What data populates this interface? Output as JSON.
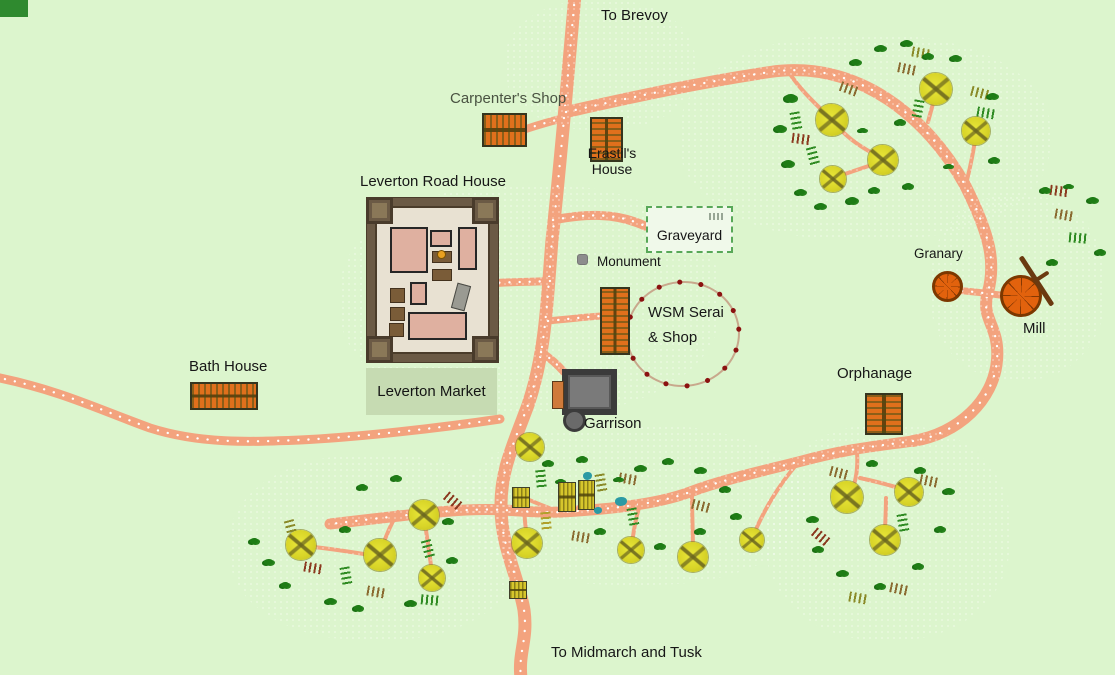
{
  "map_title": "Leverton town map",
  "palette": {
    "background": "#dcf5cd",
    "road": "#f3a37e",
    "road_dots": "#ffffff",
    "tree": "#d9d528",
    "bush": "#1e7c15",
    "pond": "#2b9aa4",
    "fence_line": "#c8a88c",
    "fence_post": "#8b1210",
    "label_default": "#161616",
    "label_muted": "#4a5342",
    "field_colors": {
      "g": "#2f8b22",
      "o": "#8a8a28",
      "t": "#8a6a30",
      "b": "#8b3a20",
      "y": "#b0a02a"
    }
  },
  "locations": {
    "to_brevoy": {
      "label": "To Brevoy"
    },
    "carpenters_shop": {
      "label": "Carpenter's Shop"
    },
    "erastils_house": {
      "label_line1": "Erastil's",
      "label_line2": "House"
    },
    "leverton_road_house": {
      "label": "Leverton Road House"
    },
    "graveyard": {
      "label": "Graveyard",
      "tombstone_marks": 4
    },
    "monument": {
      "label": "Monument"
    },
    "wsm_serai": {
      "label_line1": "WSM Serai",
      "label_line2": "& Shop"
    },
    "granary": {
      "label": "Granary"
    },
    "mill": {
      "label": "Mill"
    },
    "bath_house": {
      "label": "Bath House"
    },
    "leverton_market": {
      "label": "Leverton Market"
    },
    "garrison": {
      "label": "Garrison"
    },
    "orphanage": {
      "label": "Orphanage"
    },
    "to_midmarch": {
      "label": "To Midmarch and Tusk"
    }
  },
  "features": {
    "roads": [
      {
        "d": "M575,-5 C570,50 560,170 552,240 C547,300 546,352 528,405 C512,448 500,472 501,510 C502,548 518,576 524,610 C528,640 518,652 521,678",
        "w": 13,
        "dots": true
      },
      {
        "d": "M566,112 C620,100 690,84 770,72 C858,59 928,118 965,185 C990,235 996,262 988,292 C980,320 1000,325 997,360 C994,400 958,434 913,441",
        "w": 12,
        "dots": true
      },
      {
        "d": "M913,441 C870,447 846,449 798,462 C758,472 722,480 690,492 C658,504 612,509 562,512 C540,513 520,511 503,510 C470,508 430,512 330,524",
        "w": 11,
        "dots": true
      },
      {
        "d": "M-5,377 C60,390 100,410 150,428 C200,444 250,442 300,440 C360,437 440,428 500,419",
        "w": 9,
        "dots": true
      },
      {
        "d": "M564,118 C548,122 538,125 526,129",
        "w": 8,
        "dots": true
      },
      {
        "d": "M553,220 C585,214 615,212 645,226",
        "w": 9,
        "dots": true
      },
      {
        "d": "M550,281 C528,282 510,282 494,283",
        "w": 8,
        "dots": true
      },
      {
        "d": "M548,321 C568,319 586,317 601,316",
        "w": 7,
        "dots": true
      },
      {
        "d": "M541,352 C550,358 557,364 564,372",
        "w": 8,
        "dots": true
      },
      {
        "d": "M952,290 C968,291 984,293 1000,295",
        "w": 7,
        "dots": true
      }
    ],
    "trails": [
      "M790,74 C802,92 818,106 830,118",
      "M834,122 C848,140 866,150 880,157",
      "M881,162 C862,168 848,173 836,177",
      "M928,122 C931,111 934,100 936,92",
      "M967,180 C971,164 974,148 976,134",
      "M398,512 C390,526 384,540 381,552",
      "M376,556 C352,552 326,548 304,546",
      "M424,517 C427,537 430,556 432,574",
      "M524,511 C525,521 526,531 527,541",
      "M549,508 C539,504 531,501 525,498",
      "M573,510 C571,506 569,503 567,500",
      "M640,504 C636,518 633,532 632,546",
      "M692,494 C692,514 693,534 693,554",
      "M797,464 C778,486 763,512 754,534",
      "M857,452 C858,466 857,478 852,490",
      "M860,478 C878,482 894,486 904,490",
      "M886,498 C886,512 885,524 885,536"
    ],
    "texture": [
      [
        680,
        35,
        370,
        205
      ],
      [
        230,
        455,
        290,
        185
      ],
      [
        465,
        425,
        340,
        160
      ],
      [
        765,
        425,
        245,
        215
      ],
      [
        930,
        195,
        175,
        185
      ],
      [
        505,
        0,
        190,
        130
      ],
      [
        340,
        185,
        380,
        230
      ]
    ],
    "trees": [
      [
        832,
        120,
        16
      ],
      [
        883,
        160,
        15
      ],
      [
        833,
        179,
        13
      ],
      [
        936,
        89,
        16
      ],
      [
        976,
        131,
        14
      ],
      [
        424,
        515,
        15
      ],
      [
        380,
        555,
        16
      ],
      [
        301,
        545,
        15
      ],
      [
        432,
        578,
        13
      ],
      [
        530,
        447,
        14
      ],
      [
        527,
        543,
        15
      ],
      [
        631,
        550,
        13
      ],
      [
        693,
        557,
        15
      ],
      [
        752,
        540,
        12
      ],
      [
        847,
        497,
        16
      ],
      [
        909,
        492,
        14
      ],
      [
        885,
        540,
        15
      ]
    ],
    "bushes": [
      [
        790,
        98,
        11
      ],
      [
        780,
        128,
        10
      ],
      [
        788,
        163,
        10
      ],
      [
        800,
        192,
        9
      ],
      [
        820,
        206,
        9
      ],
      [
        852,
        200,
        10
      ],
      [
        874,
        190,
        8
      ],
      [
        855,
        62,
        9
      ],
      [
        880,
        48,
        9
      ],
      [
        906,
        43,
        9
      ],
      [
        928,
        56,
        8
      ],
      [
        900,
        122,
        8
      ],
      [
        862,
        130,
        7
      ],
      [
        908,
        186,
        8
      ],
      [
        955,
        58,
        9
      ],
      [
        992,
        96,
        9
      ],
      [
        994,
        160,
        8
      ],
      [
        948,
        166,
        7
      ],
      [
        1045,
        190,
        8
      ],
      [
        1092,
        200,
        9
      ],
      [
        1100,
        252,
        8
      ],
      [
        1052,
        262,
        8
      ],
      [
        1068,
        186,
        7
      ],
      [
        268,
        562,
        9
      ],
      [
        285,
        585,
        8
      ],
      [
        330,
        601,
        9
      ],
      [
        358,
        608,
        8
      ],
      [
        410,
        603,
        9
      ],
      [
        452,
        560,
        8
      ],
      [
        448,
        521,
        8
      ],
      [
        345,
        529,
        8
      ],
      [
        254,
        541,
        8
      ],
      [
        362,
        487,
        8
      ],
      [
        396,
        478,
        8
      ],
      [
        548,
        463,
        8
      ],
      [
        582,
        459,
        8
      ],
      [
        640,
        468,
        9
      ],
      [
        668,
        461,
        8
      ],
      [
        700,
        470,
        9
      ],
      [
        725,
        489,
        8
      ],
      [
        736,
        516,
        8
      ],
      [
        700,
        531,
        8
      ],
      [
        660,
        546,
        8
      ],
      [
        600,
        531,
        8
      ],
      [
        560,
        481,
        7
      ],
      [
        618,
        479,
        7
      ],
      [
        812,
        519,
        9
      ],
      [
        818,
        549,
        8
      ],
      [
        842,
        573,
        9
      ],
      [
        880,
        586,
        8
      ],
      [
        918,
        566,
        8
      ],
      [
        940,
        529,
        8
      ],
      [
        948,
        491,
        9
      ],
      [
        920,
        470,
        8
      ],
      [
        872,
        463,
        8
      ]
    ],
    "fields": [
      [
        796,
        121,
        80,
        "g"
      ],
      [
        801,
        139,
        8,
        "b"
      ],
      [
        813,
        156,
        75,
        "g"
      ],
      [
        921,
        53,
        10,
        "o"
      ],
      [
        907,
        69,
        12,
        "t"
      ],
      [
        918,
        109,
        100,
        "g"
      ],
      [
        980,
        93,
        15,
        "o"
      ],
      [
        986,
        113,
        10,
        "g"
      ],
      [
        849,
        89,
        20,
        "t"
      ],
      [
        1064,
        215,
        10,
        "t"
      ],
      [
        1078,
        238,
        5,
        "g"
      ],
      [
        1059,
        191,
        8,
        "b"
      ],
      [
        313,
        568,
        10,
        "b"
      ],
      [
        346,
        576,
        80,
        "g"
      ],
      [
        376,
        592,
        10,
        "t"
      ],
      [
        428,
        549,
        75,
        "g"
      ],
      [
        453,
        501,
        40,
        "b"
      ],
      [
        430,
        600,
        5,
        "g"
      ],
      [
        291,
        529,
        75,
        "o"
      ],
      [
        541,
        479,
        85,
        "g"
      ],
      [
        601,
        483,
        80,
        "o"
      ],
      [
        628,
        479,
        10,
        "t"
      ],
      [
        633,
        517,
        80,
        "g"
      ],
      [
        701,
        506,
        15,
        "t"
      ],
      [
        581,
        537,
        10,
        "t"
      ],
      [
        546,
        521,
        85,
        "y"
      ],
      [
        821,
        537,
        40,
        "b"
      ],
      [
        903,
        523,
        80,
        "g"
      ],
      [
        929,
        481,
        12,
        "t"
      ],
      [
        858,
        598,
        10,
        "o"
      ],
      [
        899,
        589,
        12,
        "t"
      ],
      [
        839,
        473,
        15,
        "t"
      ]
    ],
    "cottages": [
      [
        512,
        487,
        18,
        21
      ],
      [
        558,
        482,
        18,
        30
      ],
      [
        578,
        480,
        17,
        30
      ],
      [
        509,
        581,
        18,
        18
      ]
    ],
    "ponds": [
      [
        583,
        472,
        9,
        8
      ],
      [
        615,
        497,
        12,
        9
      ],
      [
        594,
        507,
        8,
        7
      ]
    ]
  }
}
